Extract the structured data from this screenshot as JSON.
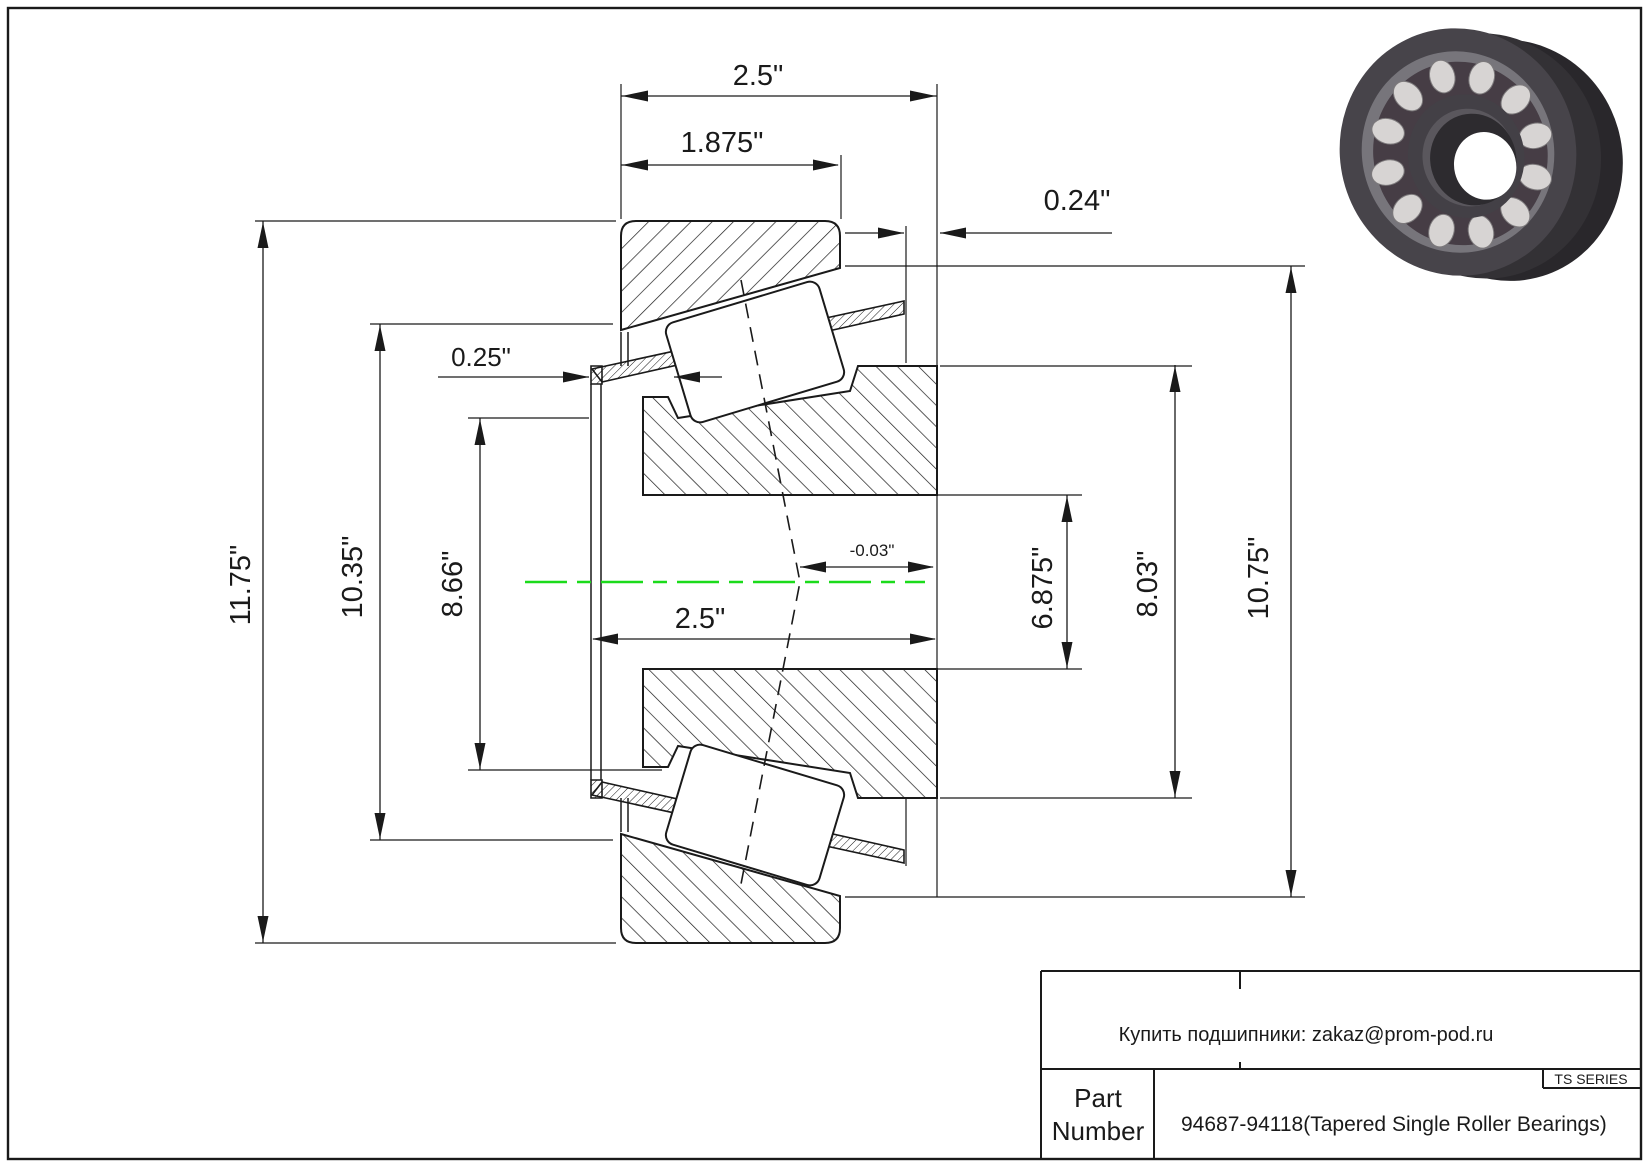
{
  "drawing": {
    "dims": {
      "overall_width": "2.5\"",
      "cup_width": "1.875\"",
      "right_offset": "0.24\"",
      "left_offset": "0.25\"",
      "outer_diameter": "11.75\"",
      "flange_diameter": "10.35\"",
      "seal_diameter": "8.66\"",
      "bore_diameter": "6.875\"",
      "rib_diameter": "8.03\"",
      "slinger_diameter": "10.75\"",
      "cone_width": "2.5\"",
      "center_offset": "-0.03\""
    },
    "colors": {
      "line": "#1a1a1a",
      "centerline": "#1bdb1b"
    }
  },
  "title_block": {
    "contact": "Купить подшипники: zakaz@prom-pod.ru",
    "series": "TS SERIES",
    "part_label_line1": "Part",
    "part_label_line2": "Number",
    "part_number": "94687-94118(Tapered Single Roller Bearings)"
  }
}
